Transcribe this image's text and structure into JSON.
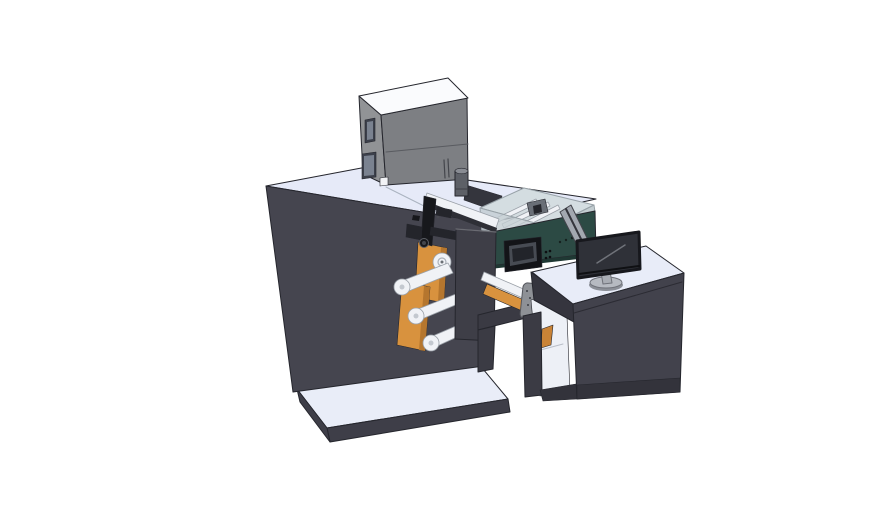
{
  "scene": {
    "type": "3d-cad-render",
    "subject": "label-printing-rewinding-machine-with-operator-desk"
  },
  "colors": {
    "bg": "#ffffff",
    "edge": "#25262d",
    "metal_edge": "#6f727a",
    "glass_edge": "#98a2a8",
    "roller_edge": "#9aa0a8",
    "cabinet_top": "#e6eaf8",
    "cabinet_front": "#45454f",
    "platform_top": "#e9edf8",
    "platform_skirt": "#3e3e48",
    "box_top": "#fafbfd",
    "box_left": "#919396",
    "box_front": "#7d7f83",
    "box_slot": "#3c404b",
    "box_slot_inner": "#7a8290",
    "chip_white": "#f2f3f6",
    "cylinder_body": "#5d6067",
    "cylinder_top": "#898c93",
    "roller": "#f0f2f6",
    "roller_dim": "#d7dbe1",
    "orange": "#d8923e",
    "orange_dark": "#b5762e",
    "orange_item": "#c98336",
    "mech_black": "#17181c",
    "mech_black2": "#24252b",
    "plate": "#3e3e47",
    "rail_dark": "#2e2f36",
    "rear_lip": "#34353d",
    "tray_top": "#d4dde1",
    "tray_mech": "#6a6f77",
    "magenta": "#c94fbe",
    "green": "#2c4a44",
    "green_dark": "#1f3833",
    "hmi_bezel": "#131418",
    "hmi_frame": "#474b53",
    "hmi_screen": "#22242a",
    "beam": "#3a3a43",
    "leg": "#3b3b44",
    "device": "#8e9196",
    "desk_top": "#e8ecf8",
    "desk_front": "#42424c",
    "desk_side": "#35353e",
    "desk_plinth": "#33333b",
    "interior": "#edf0f6",
    "panel": "#a3a8b0",
    "panel_edge": "#34353c",
    "monitor_screen": "#2f3138",
    "monitor_bezel": "#17181d",
    "monitor_reflect": "#70737a",
    "stand": "#a9adb4",
    "stand_base": "#b6bac1",
    "stand_shadow": "#8b8f97",
    "dot_dark": "#4a4b52"
  }
}
